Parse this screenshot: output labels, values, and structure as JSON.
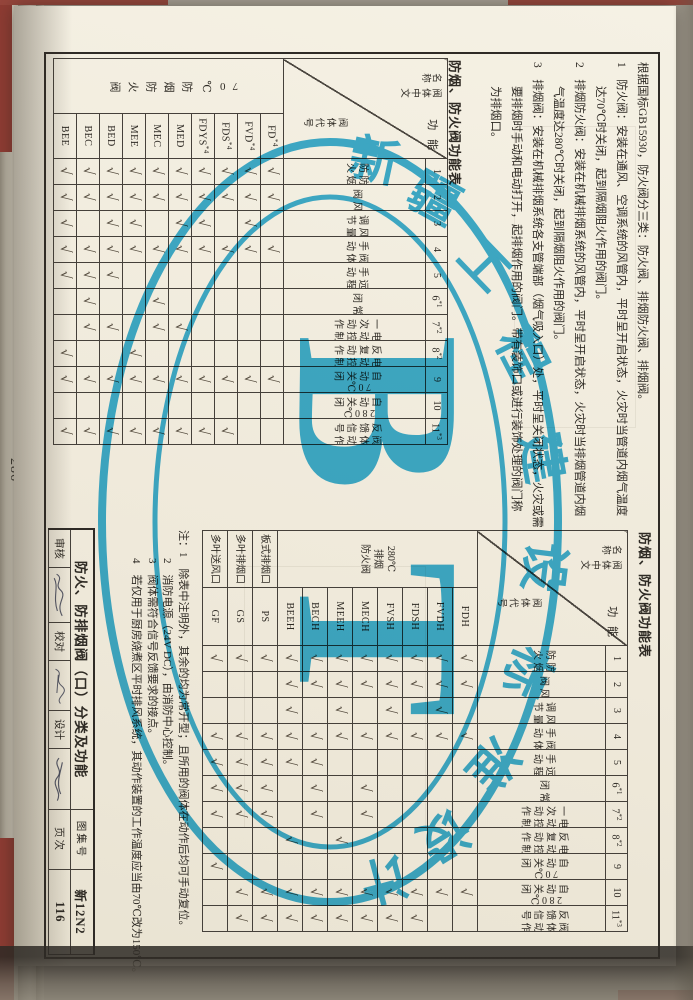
{
  "edge_page_number": "286",
  "check_glyph": "√",
  "stamp": {
    "org": "新疆工程建设标准设计",
    "arc_chars": [
      "新",
      "疆",
      "工",
      "程",
      "建",
      "设",
      "标",
      "准",
      "设",
      "计"
    ],
    "big": "BT",
    "color": "#1ba3d6"
  },
  "notes_top": {
    "l1": "根据国标GB15930，防火阀分三类：防火阀、排烟防火阀、排烟阀。",
    "l2": "1　防火阀：安装在通风、空调系统的风管内，平时呈开启状态，火灾时当管道内烟气温度",
    "l3": "达70℃时关闭，起到隔烟阻火作用的阀门。",
    "l4": "2　排烟防火阀：安装在机械排烟系统的风管内，平时呈开启状态，火灾时当排烟管道内烟",
    "l5": "气温度达280℃时关闭，起到隔烟阻火作用的阀门。",
    "l6": "3　排烟阀：安装在机械排烟系统各支管端部（烟气吸入口）处，平时呈关闭状态，火灾或需",
    "l7": "要排烟时手动和电动打开，起排烟作用的阀门。带有装饰口或进行装饰处理的阀门称",
    "l8": "为排烟口。"
  },
  "notes_bottom": {
    "n1": "注：1　除表中注明外，其余的均为常开型；且所用的阀体在动作后均可手动复位。",
    "n2": "2　消防电源（24V DC），由消防中心控制。",
    "n3": "3　阀体需符合信号反馈要求的接点。",
    "n4": "4　若仅用于厨房烧煮区平时排风系统，其动作装置的工作温度应当由70℃改为150℃。"
  },
  "titleblock": {
    "sheet_title": "防火、防排烟阀（口）分类及功能",
    "atlas_label": "图集号",
    "atlas_no": "新12N2",
    "page_label": "页次",
    "page_no": "116",
    "review_label": "审核",
    "check_label": "校对",
    "design_label": "设计"
  },
  "tables": {
    "t1": {
      "title": "防烟、防火阀功能表",
      "corner": {
        "name": "阀体中文名称",
        "func": "功 能",
        "code": "阀体代号"
      },
      "col_nums": [
        "1",
        "2",
        "3",
        "4",
        "5",
        "6*1",
        "7*2",
        "8*2",
        "9",
        "10",
        "11*3"
      ],
      "col_labels": [
        [
          "防烟",
          "防火"
        ],
        [
          "风",
          "阀"
        ],
        [
          "风量",
          "调节"
        ],
        [
          "阀体",
          "手动"
        ],
        [
          "远程",
          "手动"
        ],
        [
          "常",
          "闭"
        ],
        [
          "电动控制",
          "一次动作"
        ],
        [
          "电动控制",
          "反复动作"
        ],
        [
          "70℃",
          "自动关闭"
        ],
        [
          "280℃",
          "自动关闭"
        ],
        [
          "阀体动作",
          "反馈信号"
        ]
      ],
      "groups": [
        {
          "name": "70℃防烟防火阀",
          "mode": "vcol",
          "span": 10
        }
      ],
      "rows": [
        {
          "code": "FD*4",
          "checks": [
            1,
            1,
            0,
            1,
            0,
            0,
            0,
            0,
            1,
            0,
            0
          ]
        },
        {
          "code": "FVD*4",
          "checks": [
            1,
            1,
            1,
            1,
            0,
            0,
            0,
            0,
            1,
            0,
            0
          ]
        },
        {
          "code": "FDS*4",
          "checks": [
            1,
            1,
            0,
            1,
            0,
            0,
            0,
            0,
            1,
            0,
            1
          ]
        },
        {
          "code": "FDYS*4",
          "checks": [
            1,
            1,
            1,
            1,
            0,
            0,
            0,
            0,
            1,
            0,
            1
          ]
        },
        {
          "code": "MED",
          "checks": [
            1,
            1,
            1,
            1,
            0,
            0,
            1,
            0,
            1,
            0,
            1
          ]
        },
        {
          "code": "MEC",
          "checks": [
            1,
            1,
            0,
            1,
            0,
            1,
            1,
            0,
            1,
            0,
            1
          ]
        },
        {
          "code": "MEE",
          "checks": [
            1,
            1,
            1,
            1,
            0,
            0,
            0,
            1,
            1,
            0,
            1
          ]
        },
        {
          "code": "BED",
          "checks": [
            1,
            1,
            1,
            1,
            1,
            0,
            1,
            0,
            1,
            0,
            1
          ]
        },
        {
          "code": "BEC",
          "checks": [
            1,
            1,
            0,
            1,
            1,
            1,
            1,
            0,
            1,
            0,
            1
          ]
        },
        {
          "code": "BEE",
          "checks": [
            1,
            1,
            1,
            1,
            1,
            0,
            0,
            1,
            1,
            0,
            1
          ]
        }
      ]
    },
    "t2": {
      "title": "防烟、防火阀功能表",
      "corner": {
        "name": "阀体中文名称",
        "func": "功 能",
        "code": "阀体代号"
      },
      "col_nums": [
        "1",
        "2",
        "3",
        "4",
        "5",
        "6*1",
        "7*2",
        "8*2",
        "9",
        "10",
        "11*3"
      ],
      "col_labels": [
        [
          "防烟",
          "防火"
        ],
        [
          "风",
          "阀"
        ],
        [
          "风量",
          "调节"
        ],
        [
          "阀体",
          "手动"
        ],
        [
          "远程",
          "手动"
        ],
        [
          "常",
          "闭"
        ],
        [
          "电动控制",
          "一次动作"
        ],
        [
          "电动控制",
          "反复动作"
        ],
        [
          "70℃",
          "自动关闭"
        ],
        [
          "280℃",
          "自动关闭"
        ],
        [
          "阀体动作",
          "反馈信号"
        ]
      ],
      "groups": [
        {
          "name": "280℃\n排烟\n防火阀",
          "mode": "lines",
          "span": 8
        },
        {
          "name": "板式排烟口",
          "mode": "lines",
          "span": 1
        },
        {
          "name": "多叶排烟口",
          "mode": "lines",
          "span": 1
        },
        {
          "name": "多叶送风口",
          "mode": "lines",
          "span": 1
        }
      ],
      "rows": [
        {
          "code": "FDH",
          "checks": [
            1,
            1,
            0,
            1,
            0,
            0,
            0,
            0,
            0,
            1,
            0
          ]
        },
        {
          "code": "FVDH",
          "checks": [
            1,
            1,
            1,
            1,
            0,
            0,
            0,
            0,
            0,
            1,
            0
          ]
        },
        {
          "code": "FDSH",
          "checks": [
            1,
            1,
            0,
            1,
            0,
            0,
            0,
            0,
            0,
            1,
            1
          ]
        },
        {
          "code": "FVSH",
          "checks": [
            1,
            1,
            1,
            1,
            0,
            0,
            0,
            0,
            0,
            1,
            1
          ]
        },
        {
          "code": "MECH",
          "checks": [
            1,
            1,
            0,
            1,
            0,
            1,
            1,
            0,
            0,
            1,
            1
          ]
        },
        {
          "code": "MEEH",
          "checks": [
            1,
            1,
            1,
            1,
            0,
            0,
            0,
            1,
            0,
            1,
            1
          ]
        },
        {
          "code": "BECH",
          "checks": [
            1,
            1,
            0,
            1,
            1,
            1,
            1,
            0,
            0,
            1,
            1
          ]
        },
        {
          "code": "BEEH",
          "checks": [
            1,
            1,
            1,
            1,
            1,
            0,
            0,
            1,
            0,
            1,
            1
          ]
        },
        {
          "code": "PS",
          "checks": [
            1,
            0,
            0,
            1,
            1,
            1,
            1,
            0,
            0,
            1,
            1
          ]
        },
        {
          "code": "GS",
          "checks": [
            1,
            0,
            0,
            1,
            1,
            1,
            1,
            0,
            0,
            1,
            1
          ]
        },
        {
          "code": "GF",
          "checks": [
            1,
            0,
            0,
            1,
            1,
            1,
            1,
            0,
            1,
            0,
            0
          ]
        }
      ]
    }
  }
}
